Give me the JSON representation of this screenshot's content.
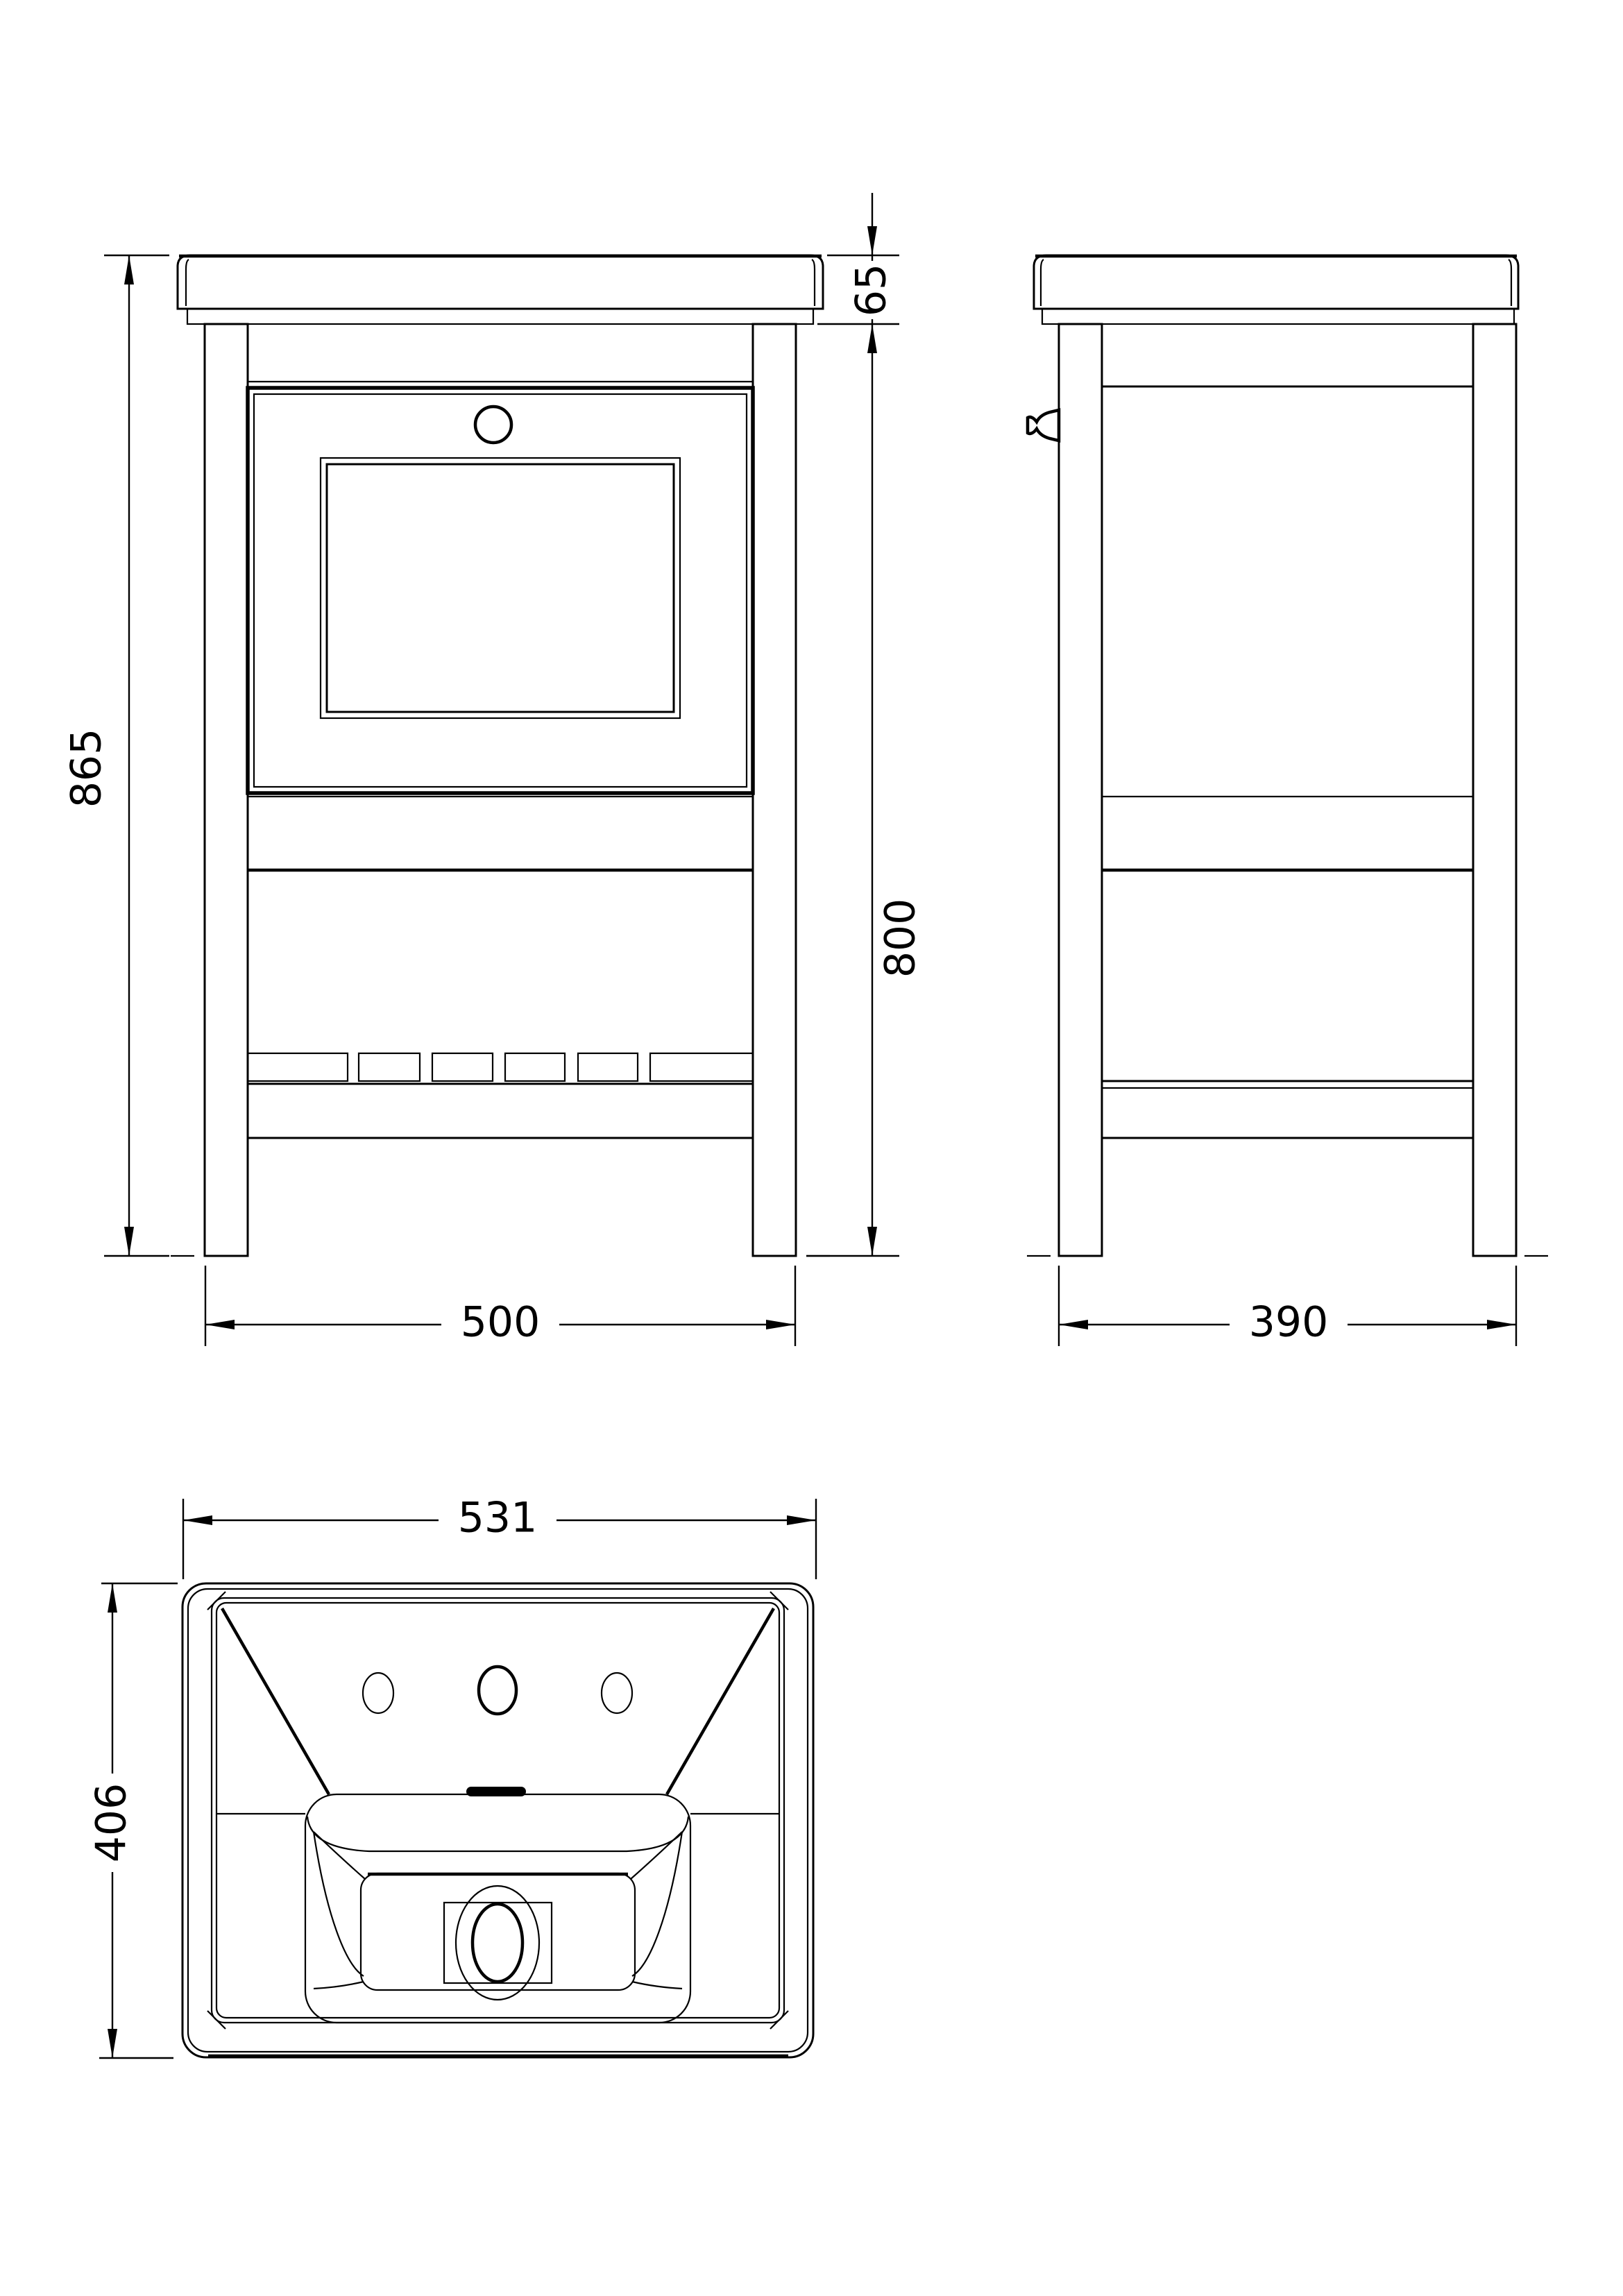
{
  "page": {
    "background_color": "#ffffff",
    "line_color": "#000000",
    "type": "technical-drawing",
    "subject": "bathroom vanity unit with basin - dimensioned orthographic views"
  },
  "drawing": {
    "views": {
      "front": {
        "label": "front-elevation",
        "dimensions": {
          "overall_height": "865",
          "worktop_thickness": "65",
          "cabinet_height": "800",
          "width": "500"
        }
      },
      "side": {
        "label": "side-elevation",
        "dimensions": {
          "depth": "390"
        }
      },
      "basin_plan": {
        "label": "basin-plan-view",
        "dimensions": {
          "width": "531",
          "depth": "406"
        }
      }
    }
  }
}
